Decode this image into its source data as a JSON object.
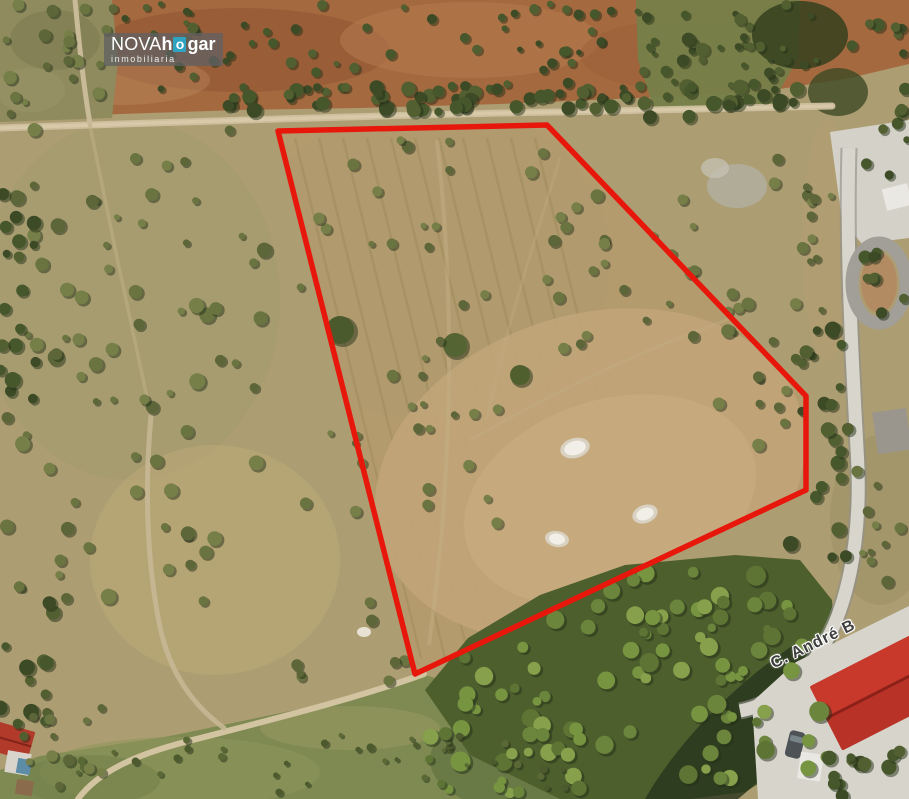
{
  "page": {
    "type": "aerial-satellite-property-photo"
  },
  "branding": {
    "name_thin": "NOVA",
    "name_bold_1": "h",
    "name_accent_letter": "o",
    "name_bold_2": "gar",
    "tagline": "inmobiliaria",
    "accent_color": "#2ea3c2"
  },
  "map": {
    "street_label": "C. André B"
  },
  "parcel_boundary": {
    "points": "278,131 547,125 806,396 806,490 415,674",
    "stroke_color": "#e8170c",
    "stroke_width": "5.5"
  }
}
